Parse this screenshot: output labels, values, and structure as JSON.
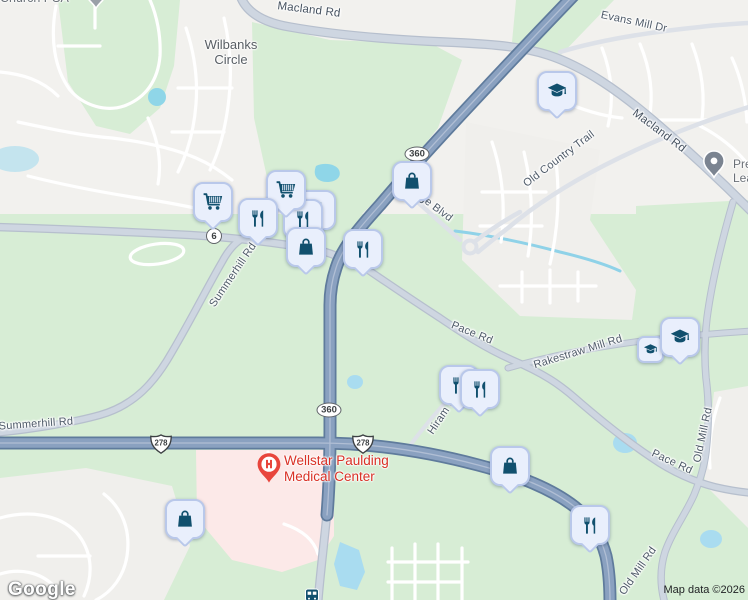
{
  "attribution": {
    "logo_text": "Google",
    "map_data_text": "Map data ©2026"
  },
  "locality_labels": {
    "church_psa": "Church PSA",
    "wilbanks_line1": "Wilbanks",
    "wilbanks_line2": "Circle"
  },
  "road_labels": {
    "macland_top": "Macland Rd",
    "macland_right": "Macland Rd",
    "evans_mill": "Evans Mill Dr",
    "old_country_trail": "Old Country Trail",
    "summerhill_west": "Summerhill Rd",
    "summerhill_north": "Summerhill Rd",
    "pace_upper": "Pace Rd",
    "pace_lower": "Pace Rd",
    "rakestraw": "Rakestraw Mill Rd",
    "old_mill_north": "Old Mill Rd",
    "old_mill_south": "Old Mill Rd",
    "hiram": "Hiram D",
    "ge_blvd": "ge Blvd"
  },
  "route_shields": {
    "sr6": "6",
    "sr360": "360",
    "us278": "278"
  },
  "poi_labels": {
    "hospital_line1": "Wellstar Paulding",
    "hospital_line2": "Medical Center",
    "clipped_right_line1": "Pre",
    "clipped_right_line2": "Lea"
  },
  "markers": {
    "icon_types": [
      "shopping-bag",
      "shopping-cart",
      "restaurant",
      "school",
      "hospital-pin",
      "generic-poi-pin",
      "bus-stop"
    ],
    "instances": [
      {
        "type": "shopping-cart",
        "x": 213,
        "y": 202
      },
      {
        "type": "shopping-cart",
        "x": 286,
        "y": 190
      },
      {
        "type": "restaurant",
        "x": 258,
        "y": 218
      },
      {
        "type": "restaurant",
        "x": 316,
        "y": 210
      },
      {
        "type": "restaurant",
        "x": 303,
        "y": 219
      },
      {
        "type": "shopping-bag",
        "x": 306,
        "y": 247
      },
      {
        "type": "restaurant",
        "x": 363,
        "y": 249
      },
      {
        "type": "shopping-bag",
        "x": 412,
        "y": 181
      },
      {
        "type": "school",
        "x": 557,
        "y": 91
      },
      {
        "type": "school",
        "x": 650,
        "y": 349
      },
      {
        "type": "school",
        "x": 680,
        "y": 337
      },
      {
        "type": "restaurant",
        "x": 459,
        "y": 385
      },
      {
        "type": "restaurant",
        "x": 480,
        "y": 389
      },
      {
        "type": "shopping-bag",
        "x": 510,
        "y": 466
      },
      {
        "type": "shopping-bag",
        "x": 185,
        "y": 519
      },
      {
        "type": "restaurant",
        "x": 590,
        "y": 525
      },
      {
        "type": "hospital-pin",
        "x": 269,
        "y": 467
      },
      {
        "type": "generic-poi-pin",
        "x": 714,
        "y": 163
      },
      {
        "type": "generic-poi-pin",
        "x": 96,
        "y": -4
      },
      {
        "type": "bus-stop",
        "x": 312,
        "y": 594
      }
    ]
  },
  "colors": {
    "base_gray": "#f2f1ee",
    "green_area": "#d7edd5",
    "residential_gray": "#f0efec",
    "hospital_pink": "#fce9e8",
    "water": "#a9dcf0",
    "water_teal": "#8fd6e8",
    "highway_fill": "#8aa1c0",
    "highway_casing": "#5f7b9c",
    "road_fill": "#ced6e1",
    "marker_bg": "#e9effc",
    "marker_border": "#b9c8ea",
    "marker_icon": "#11506e",
    "hospital_red": "#e8453c",
    "label_gray": "#4e5a68"
  }
}
